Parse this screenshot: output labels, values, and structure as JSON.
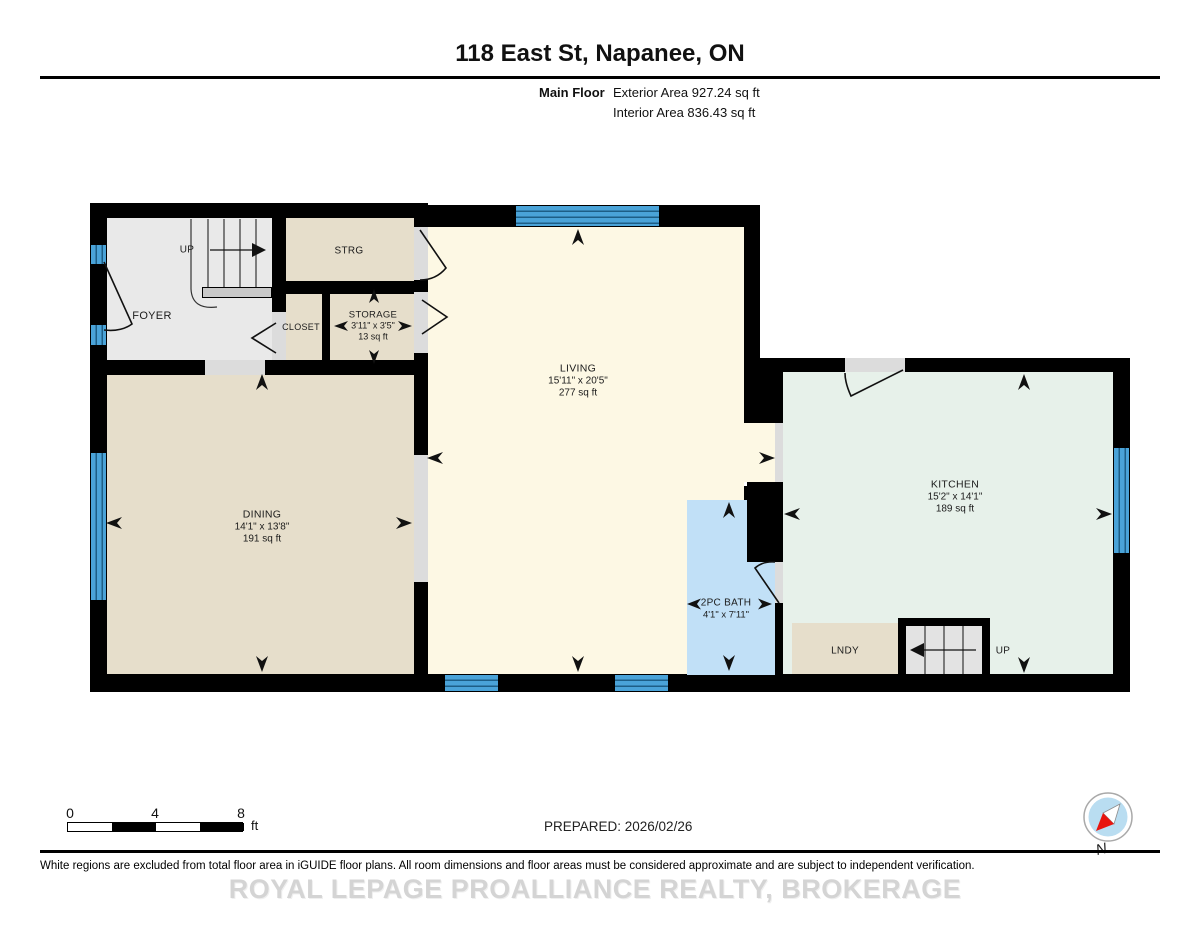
{
  "header": {
    "title": "118 East St, Napanee, ON",
    "floor_label": "Main Floor",
    "exterior_area": "Exterior Area 927.24 sq ft",
    "interior_area": "Interior Area 836.43 sq ft"
  },
  "rooms": {
    "foyer": {
      "name": "FOYER"
    },
    "foyer_stairs": {
      "label": "UP"
    },
    "strg": {
      "name": "STRG"
    },
    "closet": {
      "name": "CLOSET"
    },
    "storage": {
      "name": "STORAGE",
      "dims": "3'11\" x 3'5\"",
      "area": "13 sq ft"
    },
    "living": {
      "name": "LIVING",
      "dims": "15'11\" x 20'5\"",
      "area": "277 sq ft"
    },
    "dining": {
      "name": "DINING",
      "dims": "14'1\" x 13'8\"",
      "area": "191 sq ft"
    },
    "kitchen": {
      "name": "KITCHEN",
      "dims": "15'2\" x 14'1\"",
      "area": "189 sq ft"
    },
    "bath": {
      "name": "2PC BATH",
      "dims": "4'1\" x 7'11\""
    },
    "lndy": {
      "name": "LNDY"
    },
    "kitchen_stairs": {
      "label": "UP"
    }
  },
  "scale_bar": {
    "ticks": [
      "0",
      "4",
      "8"
    ],
    "unit": "ft"
  },
  "prepared_label": "PREPARED: 2026/02/26",
  "compass": {
    "north_label": "N"
  },
  "footer": {
    "disclaimer": "White regions are excluded from total floor area in iGUIDE floor plans. All room dimensions and floor areas must be considered approximate and are subject to independent verification.",
    "brokerage": "ROYAL LEPAGE PROALLIANCE REALTY, BROKERAGE"
  },
  "colors": {
    "wall": "#000000",
    "living_cream": "#fdf8e4",
    "tan": "#e6decb",
    "kitchen_mint": "#e7f1ea",
    "bath_blue": "#c1e0f7",
    "window_blue": "#4aa3d8",
    "excluded_gray": "#e9e9e9",
    "opening_gray": "#dcdcdc"
  }
}
